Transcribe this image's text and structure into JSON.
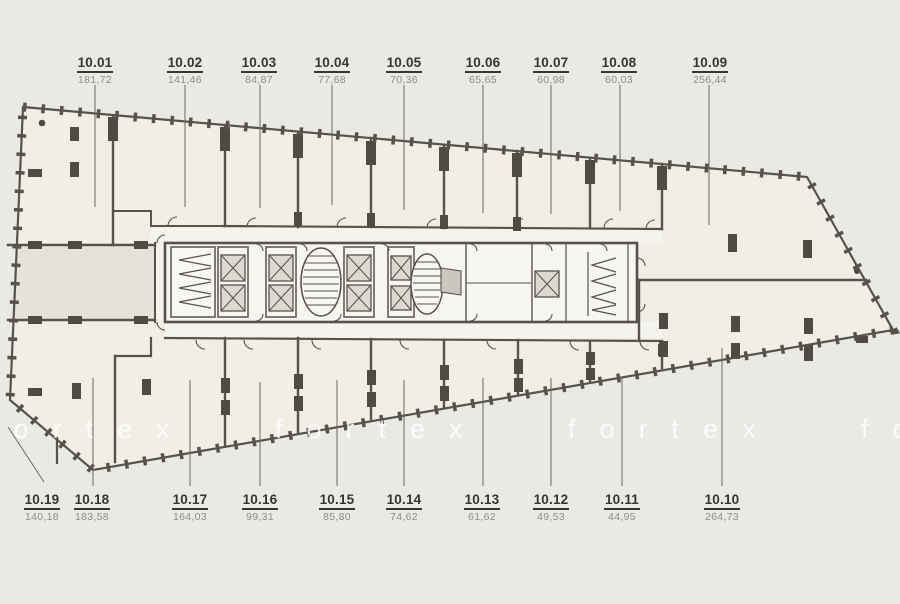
{
  "watermark": {
    "text": "fortex fortex fortex fortex",
    "color": "#ffffff"
  },
  "colors": {
    "background": "#e9e9e6",
    "unit_cream": "#f0eee5",
    "unit_gray": "#e4e2d9",
    "wall": "#57534b",
    "column": "#4f4b43",
    "core_fill": "#f6f5f1",
    "label_number": "#36352f",
    "label_area": "#8f8d84"
  },
  "units": [
    {
      "id": "10.01",
      "area": "181,72"
    },
    {
      "id": "10.02",
      "area": "141,46"
    },
    {
      "id": "10.03",
      "area": "84,87"
    },
    {
      "id": "10.04",
      "area": "77,68"
    },
    {
      "id": "10.05",
      "area": "70,36"
    },
    {
      "id": "10.06",
      "area": "65,65"
    },
    {
      "id": "10.07",
      "area": "60,98"
    },
    {
      "id": "10.08",
      "area": "60,03"
    },
    {
      "id": "10.09",
      "area": "256,44"
    },
    {
      "id": "10.10",
      "area": "264,73"
    },
    {
      "id": "10.11",
      "area": "44,95"
    },
    {
      "id": "10.12",
      "area": "49,53"
    },
    {
      "id": "10.13",
      "area": "61,62"
    },
    {
      "id": "10.14",
      "area": "74,62"
    },
    {
      "id": "10.15",
      "area": "85,80"
    },
    {
      "id": "10.16",
      "area": "99,31"
    },
    {
      "id": "10.17",
      "area": "164,03"
    },
    {
      "id": "10.18",
      "area": "183,58"
    },
    {
      "id": "10.19",
      "area": "140,18"
    }
  ]
}
